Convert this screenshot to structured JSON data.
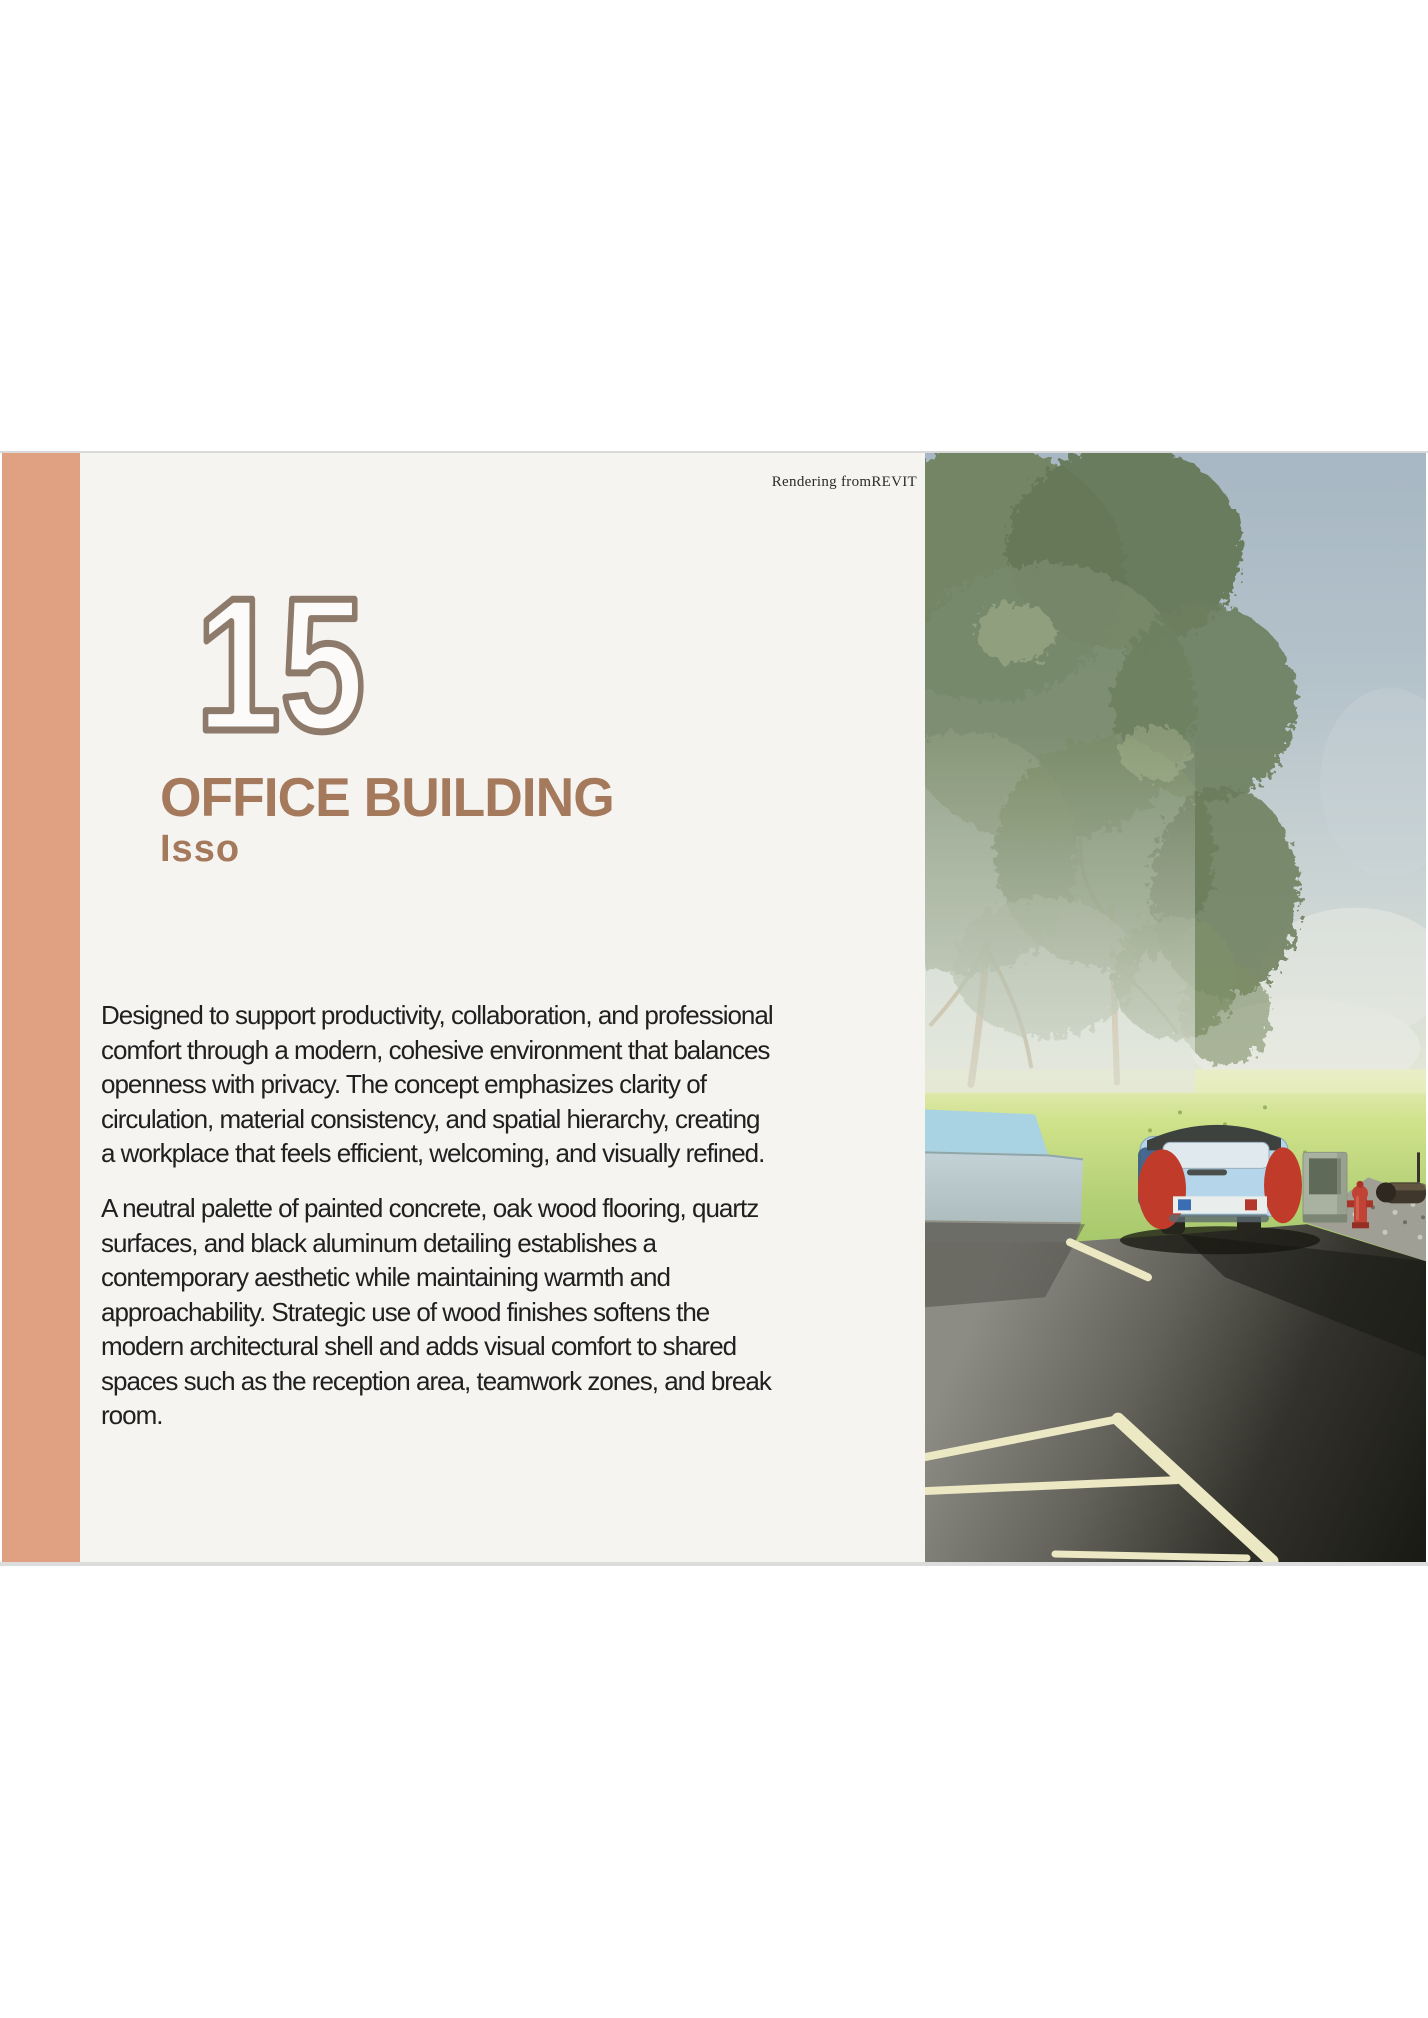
{
  "panel": {
    "credit": "Rendering fromREVIT",
    "number": "15",
    "title": "OFFICE BUILDING",
    "subtitle": "Isso",
    "paragraph1": "Designed to support productivity, collaboration, and professional\ncomfort through a modern, cohesive environment that balances\nopenness with privacy. The concept emphasizes clarity of\ncirculation, material consistency, and spatial hierarchy, creating\na workplace that feels efficient, welcoming, and visually refined.",
    "paragraph2": "A neutral palette of painted concrete, oak wood flooring, quartz\nsurfaces, and black aluminum detailing establishes a\ncontemporary aesthetic while maintaining warmth and\napproachability. Strategic use of wood finishes softens the\nmodern architectural shell and adds visual comfort to shared\nspaces such as the reception area, teamwork zones, and break\nroom."
  },
  "image": {
    "description": "Exterior rendering: large trees over a sunlit lawn, a parked classic car beside a trash bin and red fire hydrant, asphalt parking lot with pale angled bay markings"
  },
  "colors": {
    "accent_bar": "#e0a183",
    "panel_bg": "#f5f4f1",
    "heading": "#a5795c",
    "number_fill": "#fcfbfa",
    "number_outline": "#8d7a6a",
    "body_text": "#202020",
    "credit_text": "#2b2b2b",
    "band_border": "#d9d9d9",
    "parking_line": "#ece8c4"
  }
}
